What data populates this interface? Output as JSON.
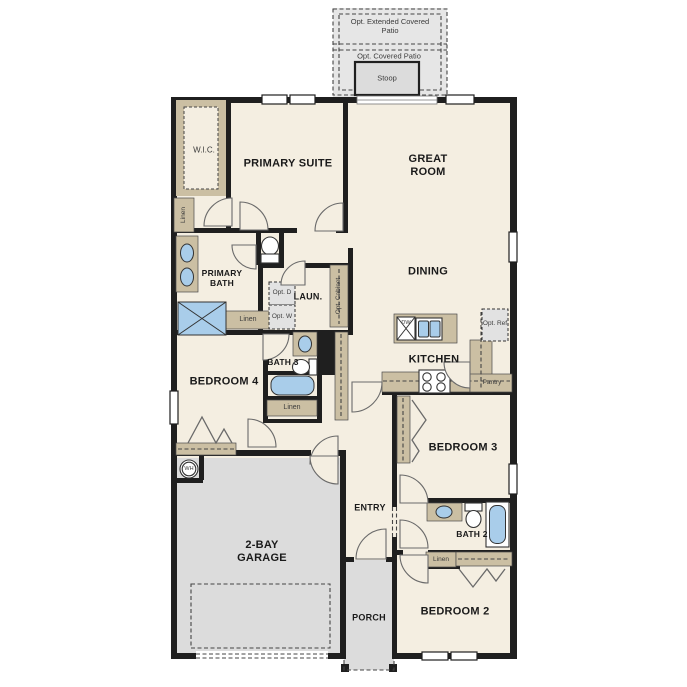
{
  "colors": {
    "floor": "#f4eee1",
    "wall": "#1f1f1f",
    "tan": "#cbbfa3",
    "blue": "#a9cdea",
    "conc": "#dcdcdc",
    "conc2": "#e6e6e6",
    "optbox": "#e2e2e2",
    "text": "#1a1a1a"
  },
  "labels": {
    "extended_patio": "Opt. Extended Covered Patio",
    "covered_patio": "Opt. Covered Patio",
    "stoop": "Stoop",
    "wic": "W.I.C.",
    "primary_suite": "PRIMARY SUITE",
    "great_room": "GREAT ROOM",
    "dining": "DINING",
    "linen_left": "Linen",
    "primary_bath": "PRIMARY BATH",
    "laundry": "LAUN.",
    "opt_dryer": "Opt. D",
    "opt_washer": "Opt. W",
    "opt_cabinet": "Opt. Cabinet",
    "linen_primary": "Linen",
    "bedroom4": "BEDROOM 4",
    "bath3": "BATH 3",
    "linen_bath3": "Linen",
    "kitchen": "KITCHEN",
    "opt_ref": "Opt. Ref",
    "pantry": "Pantry",
    "bedroom3": "BEDROOM 3",
    "entry": "ENTRY",
    "bath2": "BATH 2",
    "linen_bath2": "Linen",
    "bedroom2": "BEDROOM 2",
    "garage": "2-BAY GARAGE",
    "porch": "PORCH",
    "water_heater": "WH",
    "dishwasher": "DW"
  }
}
